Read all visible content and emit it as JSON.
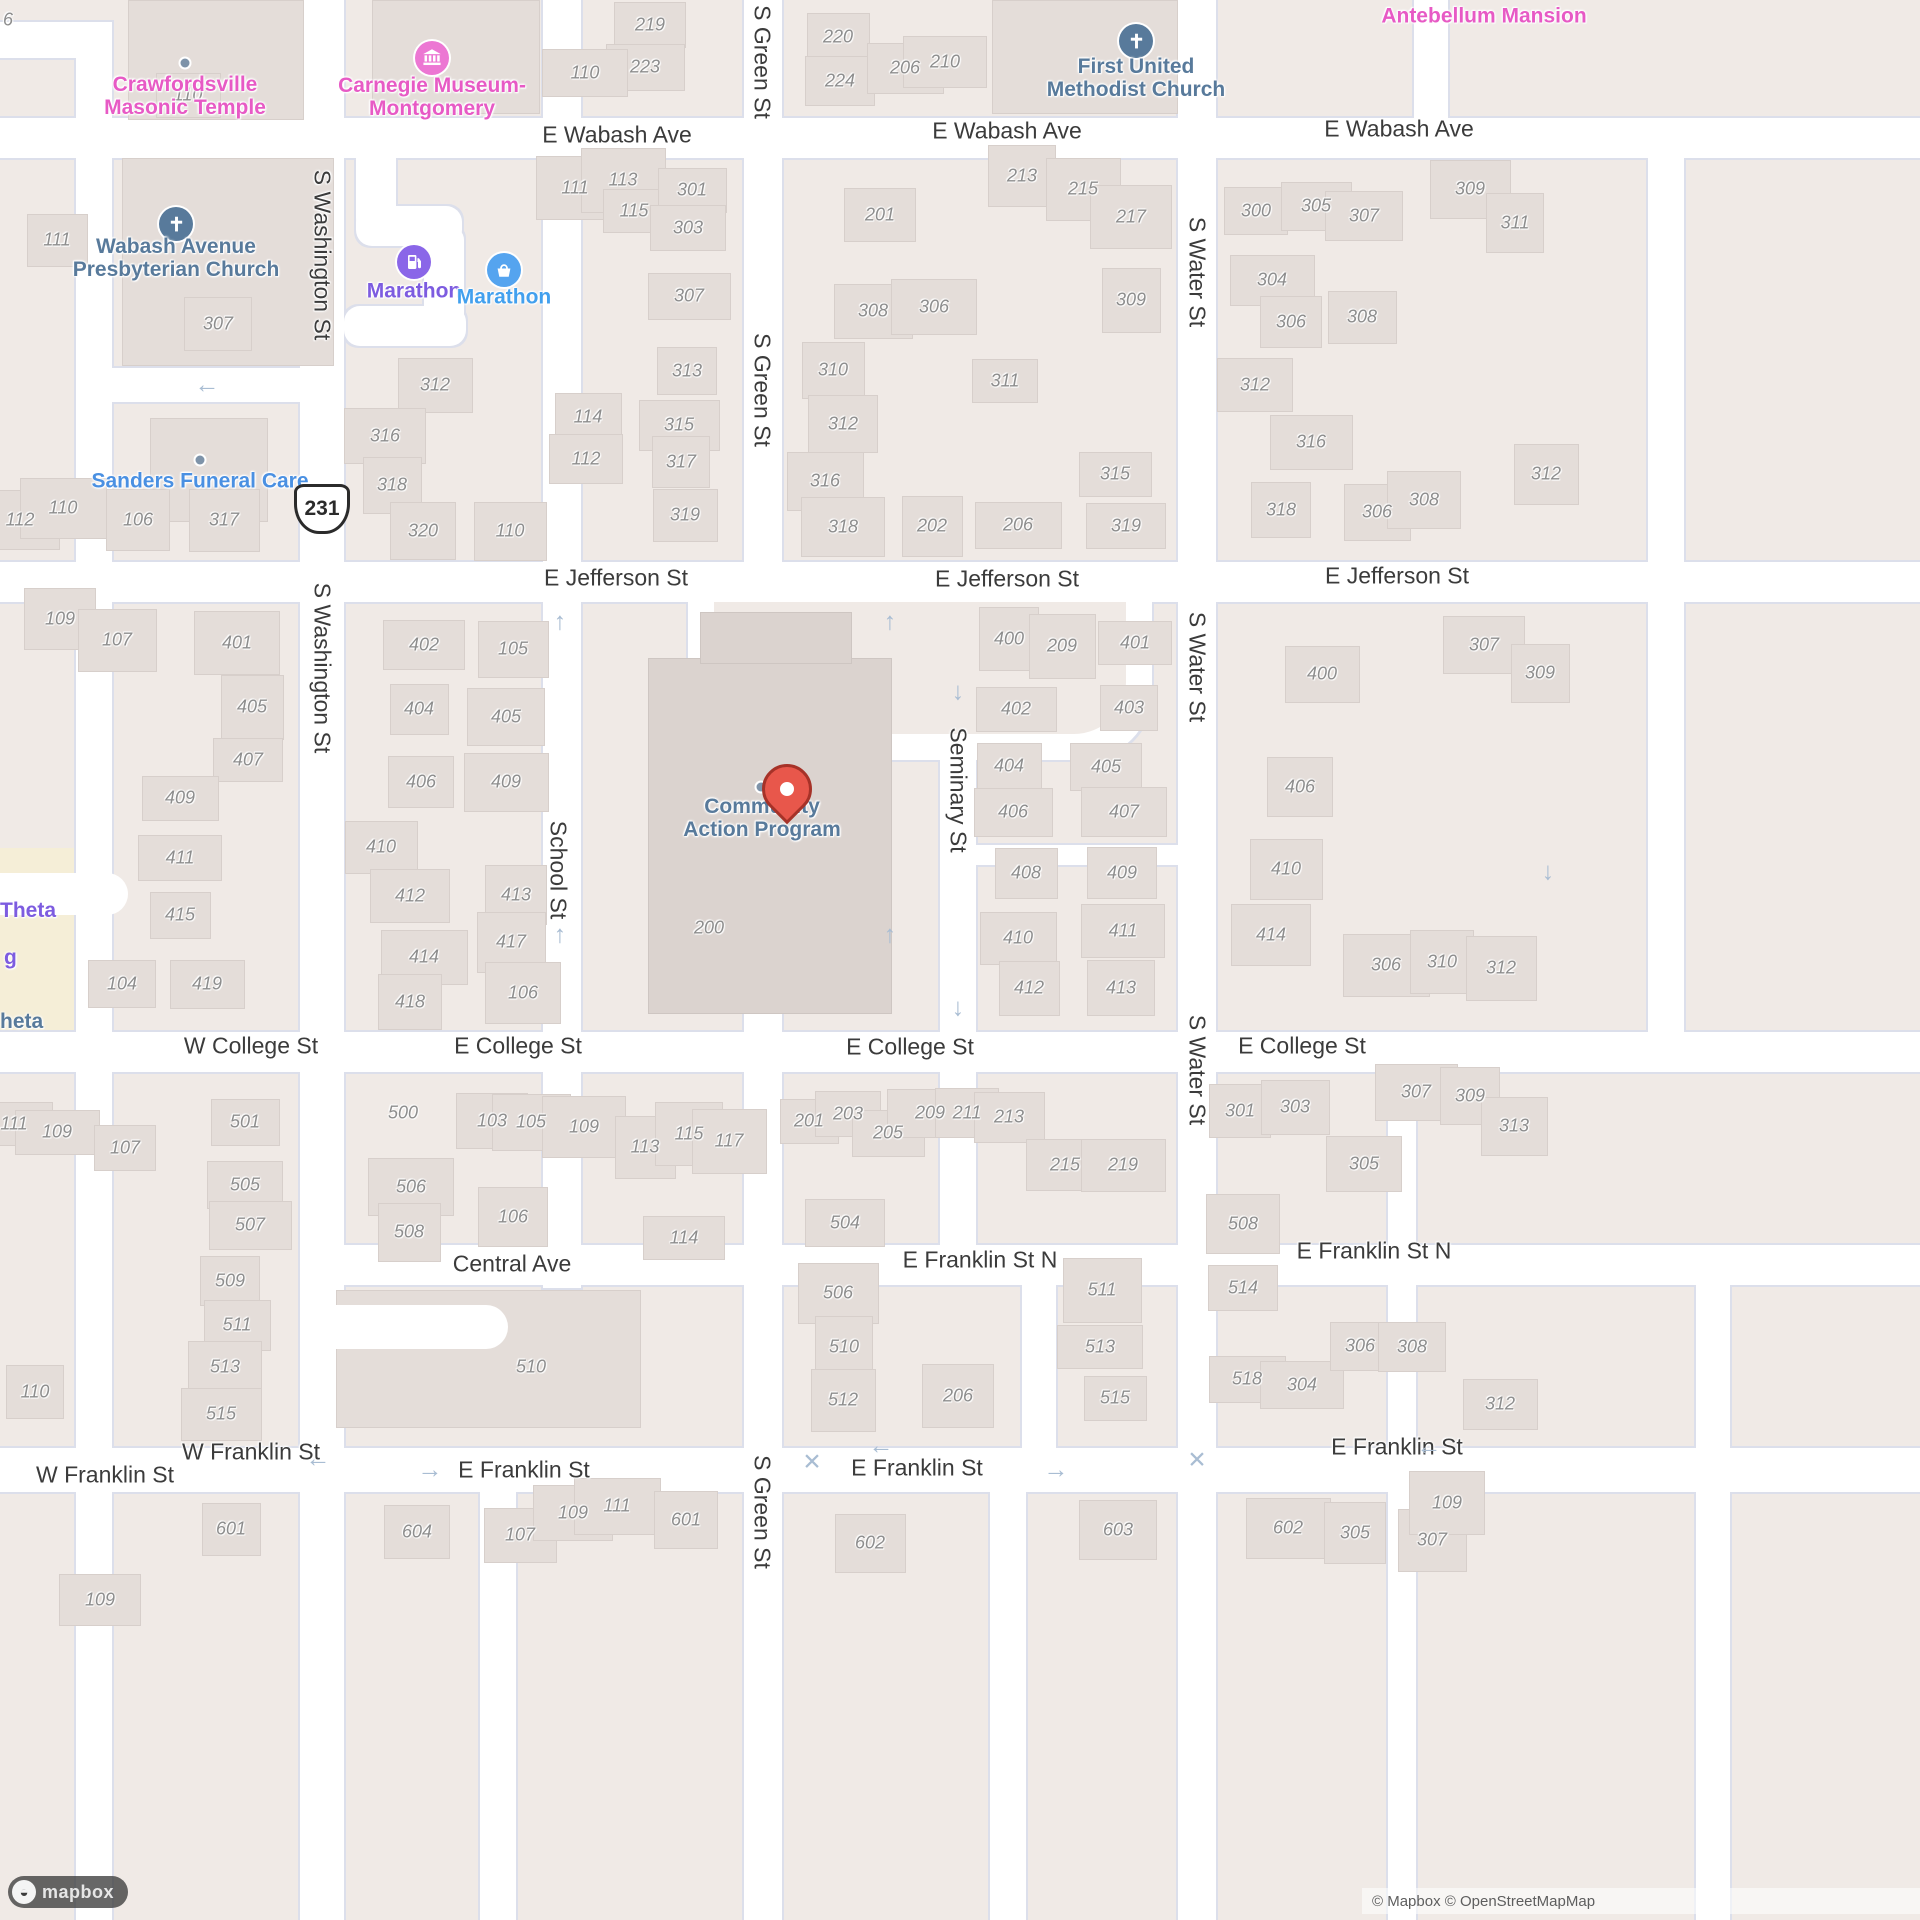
{
  "map_meta": {
    "style": "mapbox-streets-light",
    "marker_location_label": "Community Action Program",
    "colors": {
      "block": "#f0eae6",
      "road": "#ffffff",
      "casing": "#dcdfeb",
      "building": "#e4ddd9",
      "big_building": "#dbd3cf",
      "yellow_block": "#f5eed7",
      "house_number": "#8d8d8d",
      "street_label": "#3b3b3b",
      "poi_pink": "#e75ac5",
      "poi_slate": "#587a9b",
      "poi_purple": "#7d5ce0",
      "poi_blue": "#42a0ee",
      "poi_lightblue": "#4a90e2",
      "marker_red": "#e8574b",
      "arrow": "#a9bdd3"
    }
  },
  "attribution": {
    "text": "© Mapbox © OpenStreetMap",
    "clipped": "Map",
    "logo_word": "mapbox"
  },
  "shield": {
    "route": "231",
    "x": 322,
    "y": 509
  },
  "marker": {
    "x": 787,
    "y": 800,
    "dot_x": 761,
    "dot_y": 787
  },
  "roads": {
    "horizontal": [
      {
        "x": 0,
        "y": 118,
        "w": 1920,
        "h": 40
      },
      {
        "x": 0,
        "y": 562,
        "w": 1920,
        "h": 40
      },
      {
        "x": 0,
        "y": 1032,
        "w": 1920,
        "h": 40
      },
      {
        "x": 330,
        "y": 1245,
        "w": 1590,
        "h": 40
      },
      {
        "x": 0,
        "y": 1448,
        "w": 1920,
        "h": 44
      },
      {
        "x": 976,
        "y": 845,
        "w": 202,
        "h": 20
      },
      {
        "x": 0,
        "y": 22,
        "w": 112,
        "h": 36
      },
      {
        "x": 112,
        "y": 368,
        "w": 188,
        "h": 34
      }
    ],
    "hook": [
      {
        "x": 356,
        "y": 158,
        "w": 40,
        "h": 74,
        "r": "0 0 14px 14px"
      },
      {
        "x": 356,
        "y": 206,
        "w": 106,
        "h": 40,
        "r": "16px"
      },
      {
        "x": 424,
        "y": 226,
        "w": 40,
        "h": 104,
        "r": "14px"
      },
      {
        "x": 344,
        "y": 306,
        "w": 122,
        "h": 40,
        "r": "16px"
      }
    ],
    "vertical": [
      {
        "x": 76,
        "y": 22,
        "w": 36,
        "h": 1898
      },
      {
        "x": 300,
        "y": 0,
        "w": 44,
        "h": 1920
      },
      {
        "x": 543,
        "y": 0,
        "w": 38,
        "h": 1288
      },
      {
        "x": 744,
        "y": 0,
        "w": 38,
        "h": 1920
      },
      {
        "x": 940,
        "y": 562,
        "w": 36,
        "h": 723
      },
      {
        "x": 1178,
        "y": 0,
        "w": 38,
        "h": 1920
      },
      {
        "x": 1414,
        "y": 0,
        "w": 34,
        "h": 158
      },
      {
        "x": 1648,
        "y": 158,
        "w": 36,
        "h": 874
      },
      {
        "x": 1022,
        "y": 1285,
        "w": 34,
        "h": 207
      },
      {
        "x": 1388,
        "y": 1072,
        "w": 28,
        "h": 848
      },
      {
        "x": 1696,
        "y": 1285,
        "w": 34,
        "h": 635
      },
      {
        "x": 480,
        "y": 1492,
        "w": 36,
        "h": 428
      },
      {
        "x": 990,
        "y": 1492,
        "w": 36,
        "h": 428
      }
    ],
    "loop": {
      "outer": {
        "x": 688,
        "y": 602,
        "w": 464,
        "h": 158,
        "r": "0 0 70px 70px"
      },
      "inner": {
        "x": 714,
        "y": 602,
        "w": 412,
        "h": 132,
        "r": "0 0 52px 52px"
      }
    },
    "driveways": [
      {
        "x": 336,
        "y": 1305,
        "w": 172,
        "h": 44,
        "r": "0 22px 22px 0"
      },
      {
        "x": 0,
        "y": 873,
        "w": 128,
        "h": 42,
        "r": "0 21px 21px 0"
      }
    ]
  },
  "special_blocks": [
    {
      "x": 0,
      "y": 848,
      "w": 84,
      "h": 190
    }
  ],
  "big_buildings": [
    {
      "x": 128,
      "y": 0,
      "w": 176,
      "h": 120
    },
    {
      "x": 372,
      "y": 0,
      "w": 168,
      "h": 114
    },
    {
      "x": 122,
      "y": 158,
      "w": 212,
      "h": 208
    },
    {
      "x": 992,
      "y": 0,
      "w": 186,
      "h": 114
    },
    {
      "x": 150,
      "y": 418,
      "w": 118,
      "h": 104
    },
    {
      "x": 648,
      "y": 658,
      "w": 244,
      "h": 356,
      "dark": 1
    },
    {
      "x": 700,
      "y": 612,
      "w": 152,
      "h": 52,
      "dark": 1
    },
    {
      "x": 336,
      "y": 1290,
      "w": 305,
      "h": 138
    }
  ],
  "street_labels_h": [
    [
      "E Wabash Ave",
      617,
      135
    ],
    [
      "E Wabash Ave",
      1007,
      131
    ],
    [
      "E Wabash Ave",
      1399,
      129
    ],
    [
      "E Jefferson St",
      616,
      578
    ],
    [
      "E Jefferson St",
      1007,
      579
    ],
    [
      "E Jefferson St",
      1397,
      576
    ],
    [
      "W College St",
      251,
      1046
    ],
    [
      "E College St",
      518,
      1046
    ],
    [
      "E College St",
      910,
      1047
    ],
    [
      "E College St",
      1302,
      1046
    ],
    [
      "Central Ave",
      512,
      1264
    ],
    [
      "E Franklin St N",
      980,
      1260
    ],
    [
      "E Franklin St N",
      1374,
      1251
    ],
    [
      "W Franklin St",
      251,
      1452
    ],
    [
      "W Franklin St",
      105,
      1475
    ],
    [
      "E Franklin St",
      524,
      1470
    ],
    [
      "E Franklin St",
      917,
      1468
    ],
    [
      "E Franklin St",
      1397,
      1447
    ]
  ],
  "street_labels_v": [
    [
      "S Washington St",
      322,
      255
    ],
    [
      "S Washington St",
      322,
      668
    ],
    [
      "S Green St",
      762,
      62
    ],
    [
      "S Green St",
      762,
      390
    ],
    [
      "S Green St",
      762,
      1512
    ],
    [
      "School St",
      558,
      870
    ],
    [
      "Seminary St",
      958,
      790
    ],
    [
      "S Water St",
      1197,
      272
    ],
    [
      "S Water St",
      1197,
      667
    ],
    [
      "S Water St",
      1197,
      1070
    ]
  ],
  "arrows": [
    [
      "←",
      207,
      385
    ],
    [
      "↑",
      560,
      622
    ],
    [
      "↑",
      890,
      622
    ],
    [
      "↓",
      958,
      692
    ],
    [
      "↑",
      560,
      935
    ],
    [
      "↑",
      890,
      935
    ],
    [
      "↓",
      958,
      1008
    ],
    [
      "↓",
      1548,
      872
    ],
    [
      "←",
      318,
      1459
    ],
    [
      "→",
      430,
      1470
    ],
    [
      "←",
      881,
      1446
    ],
    [
      "→",
      1056,
      1470
    ],
    [
      "←",
      1429,
      1447
    ]
  ],
  "x_marks": [
    [
      812,
      1462
    ],
    [
      1197,
      1460
    ]
  ],
  "pois": [
    {
      "name": "crawfordsville-masonic-temple",
      "lines": [
        "Crawfordsville",
        "Masonic Temple"
      ],
      "color": "#e75ac5",
      "x": 185,
      "y": 96,
      "dot": [
        185,
        63
      ]
    },
    {
      "name": "carnegie-museum-montgomery",
      "lines": [
        "Carnegie Museum-",
        "Montgomery"
      ],
      "color": "#e75ac5",
      "x": 432,
      "y": 97,
      "icon": {
        "type": "museum",
        "bg": "#ec77d3",
        "x": 432,
        "y": 58
      }
    },
    {
      "name": "wabash-avenue-presbyterian-church",
      "lines": [
        "Wabash Avenue",
        "Presbyterian Church"
      ],
      "color": "#587a9b",
      "x": 176,
      "y": 258,
      "icon": {
        "type": "cross",
        "bg": "#587a9b",
        "x": 176,
        "y": 224
      }
    },
    {
      "name": "marathon-fuel",
      "lines": [
        "Marathon"
      ],
      "color": "#7d5ce0",
      "x": 414,
      "y": 291,
      "icon": {
        "type": "fuel",
        "bg": "#8a66e8",
        "x": 414,
        "y": 262
      }
    },
    {
      "name": "marathon-store",
      "lines": [
        "Marathon"
      ],
      "color": "#42a0ee",
      "x": 504,
      "y": 297,
      "icon": {
        "type": "basket",
        "bg": "#55a4ef",
        "x": 504,
        "y": 270
      }
    },
    {
      "name": "first-united-methodist-church",
      "lines": [
        "First United",
        "Methodist Church"
      ],
      "color": "#587a9b",
      "x": 1136,
      "y": 78,
      "icon": {
        "type": "cross",
        "bg": "#587a9b",
        "x": 1136,
        "y": 41
      }
    },
    {
      "name": "antebellum-mansion",
      "lines": [
        "Antebellum Mansion"
      ],
      "color": "#e75ac5",
      "x": 1484,
      "y": 16
    },
    {
      "name": "sanders-funeral-care",
      "lines": [
        "Sanders Funeral Care"
      ],
      "color": "#4a90e2",
      "x": 200,
      "y": 481,
      "dot": [
        200,
        460
      ]
    },
    {
      "name": "community-action-program",
      "lines": [
        "Community",
        "Action Program"
      ],
      "color": "#587a9b",
      "x": 762,
      "y": 818,
      "dot": [
        761,
        787
      ]
    }
  ],
  "edge_labels": [
    {
      "text": "Theta",
      "color": "#7d5ce0",
      "x": 0,
      "y": 911
    },
    {
      "text": "g",
      "color": "#7d5ce0",
      "x": 4,
      "y": 958
    },
    {
      "text": "heta",
      "color": "#587a9b",
      "x": 0,
      "y": 1022
    }
  ],
  "house_numbers": [
    [
      "6",
      8,
      20,
      0
    ],
    [
      "110",
      188,
      95
    ],
    [
      "219",
      650,
      25
    ],
    [
      "223",
      645,
      67
    ],
    [
      "110",
      585,
      73
    ],
    [
      "220",
      838,
      37
    ],
    [
      "224",
      840,
      81
    ],
    [
      "206",
      905,
      68
    ],
    [
      "210",
      945,
      62
    ],
    [
      "111",
      57,
      240
    ],
    [
      "307",
      218,
      324
    ],
    [
      "312",
      435,
      385
    ],
    [
      "316",
      385,
      436
    ],
    [
      "318",
      392,
      485
    ],
    [
      "320",
      423,
      531
    ],
    [
      "110",
      510,
      531
    ],
    [
      "112",
      20,
      520
    ],
    [
      "110",
      63,
      508
    ],
    [
      "106",
      138,
      520
    ],
    [
      "317",
      224,
      520
    ],
    [
      "111",
      575,
      188
    ],
    [
      "113",
      623,
      180
    ],
    [
      "115",
      634,
      211
    ],
    [
      "301",
      692,
      190
    ],
    [
      "303",
      688,
      228
    ],
    [
      "307",
      689,
      296
    ],
    [
      "313",
      687,
      371
    ],
    [
      "114",
      588,
      417
    ],
    [
      "112",
      586,
      459
    ],
    [
      "315",
      679,
      425
    ],
    [
      "317",
      681,
      462
    ],
    [
      "319",
      685,
      515
    ],
    [
      "201",
      880,
      215
    ],
    [
      "308",
      873,
      311
    ],
    [
      "306",
      934,
      307
    ],
    [
      "310",
      833,
      370
    ],
    [
      "312",
      843,
      424
    ],
    [
      "316",
      825,
      481
    ],
    [
      "318",
      843,
      527
    ],
    [
      "202",
      932,
      526
    ],
    [
      "213",
      1022,
      176
    ],
    [
      "215",
      1083,
      189
    ],
    [
      "217",
      1131,
      217
    ],
    [
      "309",
      1131,
      300
    ],
    [
      "311",
      1005,
      381
    ],
    [
      "315",
      1115,
      474
    ],
    [
      "319",
      1126,
      526
    ],
    [
      "206",
      1018,
      525
    ],
    [
      "300",
      1256,
      211
    ],
    [
      "305",
      1316,
      206
    ],
    [
      "307",
      1364,
      216
    ],
    [
      "304",
      1272,
      280
    ],
    [
      "306",
      1291,
      322
    ],
    [
      "308",
      1362,
      317
    ],
    [
      "312",
      1255,
      385
    ],
    [
      "316",
      1311,
      442
    ],
    [
      "318",
      1281,
      510
    ],
    [
      "306",
      1377,
      512
    ],
    [
      "308",
      1424,
      500
    ],
    [
      "309",
      1470,
      189
    ],
    [
      "311",
      1515,
      223
    ],
    [
      "312",
      1546,
      474
    ],
    [
      "109",
      60,
      619
    ],
    [
      "107",
      117,
      640
    ],
    [
      "401",
      237,
      643
    ],
    [
      "405",
      252,
      707
    ],
    [
      "407",
      248,
      760
    ],
    [
      "409",
      180,
      798
    ],
    [
      "411",
      180,
      858
    ],
    [
      "415",
      180,
      915
    ],
    [
      "104",
      122,
      984
    ],
    [
      "419",
      207,
      984
    ],
    [
      "402",
      424,
      645
    ],
    [
      "404",
      419,
      709
    ],
    [
      "406",
      421,
      782
    ],
    [
      "410",
      381,
      847
    ],
    [
      "412",
      410,
      896
    ],
    [
      "414",
      424,
      957
    ],
    [
      "418",
      410,
      1002
    ],
    [
      "105",
      513,
      649
    ],
    [
      "405",
      506,
      717
    ],
    [
      "409",
      506,
      782
    ],
    [
      "413",
      516,
      895
    ],
    [
      "417",
      511,
      942
    ],
    [
      "106",
      523,
      993
    ],
    [
      "200",
      709,
      928,
      0
    ],
    [
      "400",
      1009,
      639
    ],
    [
      "209",
      1062,
      646
    ],
    [
      "401",
      1135,
      643
    ],
    [
      "402",
      1016,
      709
    ],
    [
      "403",
      1129,
      708
    ],
    [
      "404",
      1009,
      766
    ],
    [
      "405",
      1106,
      767
    ],
    [
      "406",
      1013,
      812
    ],
    [
      "407",
      1124,
      812
    ],
    [
      "408",
      1026,
      873
    ],
    [
      "409",
      1122,
      873
    ],
    [
      "410",
      1018,
      938
    ],
    [
      "411",
      1123,
      931
    ],
    [
      "412",
      1029,
      988
    ],
    [
      "413",
      1121,
      988
    ],
    [
      "400",
      1322,
      674
    ],
    [
      "307",
      1484,
      645
    ],
    [
      "309",
      1540,
      673
    ],
    [
      "406",
      1300,
      787
    ],
    [
      "410",
      1286,
      869
    ],
    [
      "414",
      1271,
      935
    ],
    [
      "306",
      1386,
      965
    ],
    [
      "310",
      1442,
      962
    ],
    [
      "312",
      1501,
      968
    ],
    [
      "111",
      14,
      1124
    ],
    [
      "109",
      57,
      1132
    ],
    [
      "107",
      125,
      1148
    ],
    [
      "501",
      245,
      1122
    ],
    [
      "505",
      245,
      1185
    ],
    [
      "507",
      250,
      1225
    ],
    [
      "509",
      230,
      1281
    ],
    [
      "511",
      237,
      1325
    ],
    [
      "513",
      225,
      1367
    ],
    [
      "515",
      221,
      1414
    ],
    [
      "110",
      35,
      1392
    ],
    [
      "500",
      403,
      1113,
      0
    ],
    [
      "103",
      492,
      1121
    ],
    [
      "105",
      531,
      1122
    ],
    [
      "506",
      411,
      1187
    ],
    [
      "508",
      409,
      1232
    ],
    [
      "106",
      513,
      1217
    ],
    [
      "510",
      531,
      1367,
      0
    ],
    [
      "109",
      584,
      1127
    ],
    [
      "113",
      645,
      1147
    ],
    [
      "115",
      689,
      1134
    ],
    [
      "117",
      729,
      1141
    ],
    [
      "114",
      684,
      1238
    ],
    [
      "201",
      809,
      1121
    ],
    [
      "203",
      848,
      1114
    ],
    [
      "205",
      888,
      1133
    ],
    [
      "504",
      845,
      1223
    ],
    [
      "209",
      930,
      1113
    ],
    [
      "211",
      967,
      1113
    ],
    [
      "213",
      1009,
      1117
    ],
    [
      "215",
      1065,
      1165
    ],
    [
      "219",
      1123,
      1165
    ],
    [
      "301",
      1240,
      1111
    ],
    [
      "303",
      1295,
      1107
    ],
    [
      "305",
      1364,
      1164
    ],
    [
      "307",
      1416,
      1092
    ],
    [
      "309",
      1470,
      1096
    ],
    [
      "313",
      1514,
      1126
    ],
    [
      "508",
      1243,
      1224
    ],
    [
      "506",
      838,
      1293
    ],
    [
      "510",
      844,
      1347
    ],
    [
      "512",
      843,
      1400
    ],
    [
      "206",
      958,
      1396
    ],
    [
      "511",
      1102,
      1290
    ],
    [
      "513",
      1100,
      1347
    ],
    [
      "515",
      1115,
      1398
    ],
    [
      "514",
      1243,
      1288
    ],
    [
      "518",
      1247,
      1379
    ],
    [
      "304",
      1302,
      1385
    ],
    [
      "306",
      1360,
      1346
    ],
    [
      "308",
      1412,
      1347
    ],
    [
      "312",
      1500,
      1404
    ],
    [
      "109",
      100,
      1600
    ],
    [
      "601",
      231,
      1529
    ],
    [
      "604",
      417,
      1532
    ],
    [
      "107",
      520,
      1535
    ],
    [
      "109",
      573,
      1513
    ],
    [
      "111",
      617,
      1506
    ],
    [
      "601",
      686,
      1520
    ],
    [
      "602",
      870,
      1543
    ],
    [
      "603",
      1118,
      1530
    ],
    [
      "602",
      1288,
      1528
    ],
    [
      "305",
      1355,
      1533
    ],
    [
      "307",
      1432,
      1540
    ],
    [
      "109",
      1447,
      1503
    ]
  ]
}
